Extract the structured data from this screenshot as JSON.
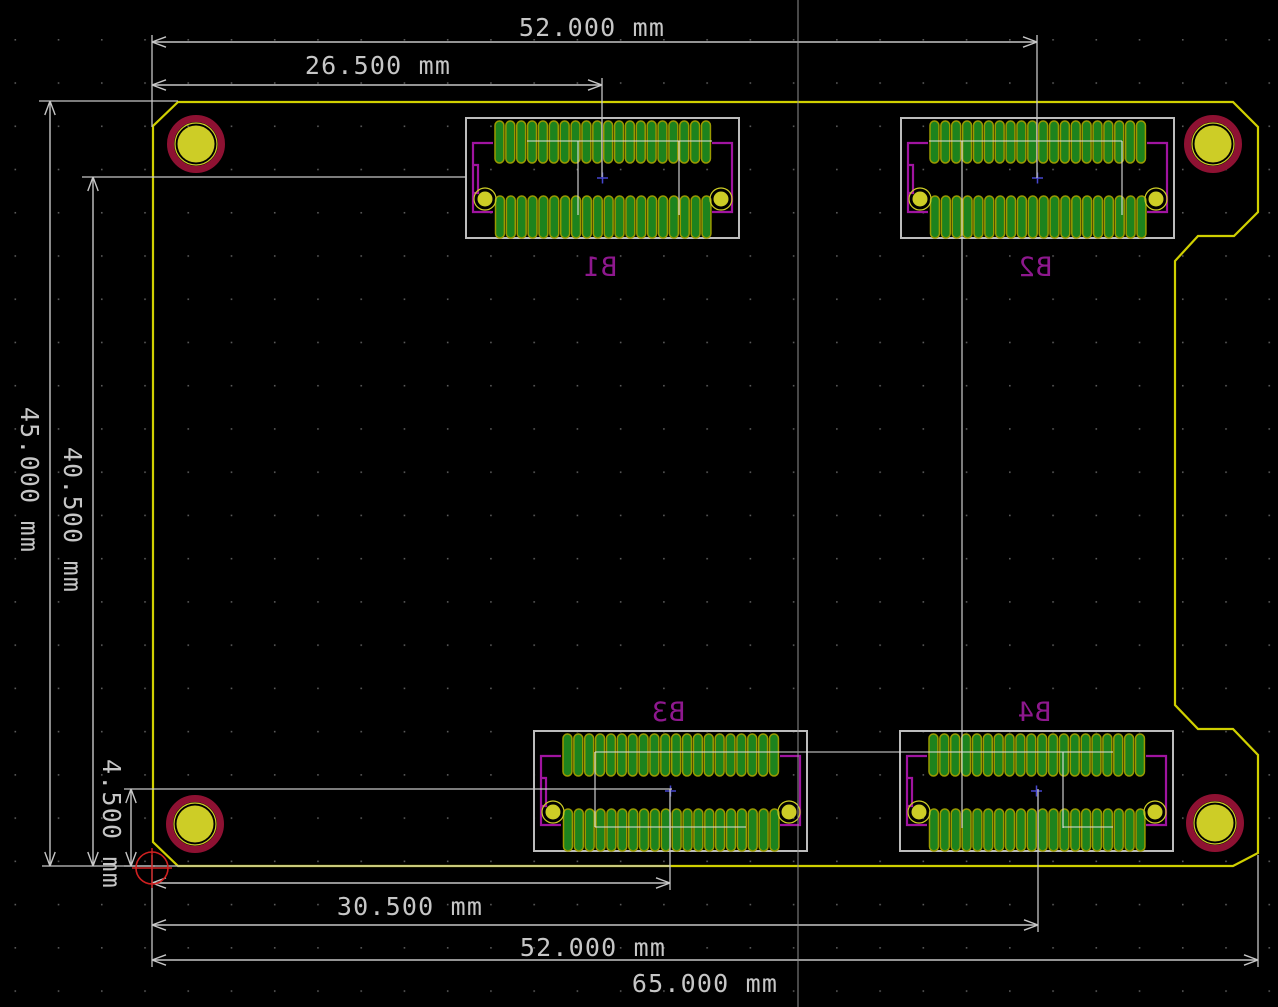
{
  "app": {
    "name": "pcb-editor-canvas",
    "units": "mm"
  },
  "canvas": {
    "width": 1278,
    "height": 1007,
    "background": "#000000"
  },
  "colors": {
    "grid_dot": "#5a5a5a",
    "edge_cuts": "#d0d000",
    "dimension": "#c6c6c6",
    "ratsnest": "#e0e0e0",
    "courtyard": "#bcbcbc",
    "pad_green": "#1d831d",
    "pad_outline": "#9a9a00",
    "pad_yellow": "#cdcd26",
    "hole_ring": "#8e1132",
    "silk_bracket": "#a014a0",
    "silk_label": "#8e188e",
    "anchor_blue": "#4646cf",
    "origin_red": "#d02020",
    "cursor": "#909090"
  },
  "grid": {
    "spacing": 43.24,
    "offset_x": 14.5,
    "offset_y": 39,
    "dot_size": 1.6
  },
  "board": {
    "outline_points": "178,102 1233,102 1258,127 1258,212 1234,236 1198,236 1175,261 1175,705 1198,729 1233,729 1258,755 1258,853 1233,866 178,866 153,842 153,126"
  },
  "mounting_holes": [
    {
      "x": 196,
      "y": 144
    },
    {
      "x": 1213,
      "y": 144
    },
    {
      "x": 195,
      "y": 824
    },
    {
      "x": 1215,
      "y": 823
    }
  ],
  "connector_geom": {
    "width": 273,
    "height": 120,
    "pads_per_row": 20,
    "pad_pitch": 10.87,
    "pad_w": 8.9,
    "pad_h": 42,
    "row1_x": 29,
    "row1_y": 3,
    "row2_x": 29.5,
    "row2_y": 78,
    "hole_pads": [
      {
        "cx": 19,
        "cy": 81
      },
      {
        "cx": 255,
        "cy": 81
      }
    ],
    "bracket_left": "M27 25 H7 V94 H27 M7 47 H12 V75 H7",
    "bracket_right": "M246 25 H266 V94 H246",
    "anchor": {
      "x": 136.5,
      "y": 60
    }
  },
  "connectors": [
    {
      "ref": "B1",
      "x": 466,
      "y": 118,
      "label_pos": "below"
    },
    {
      "ref": "B2",
      "x": 901,
      "y": 118,
      "label_pos": "below"
    },
    {
      "ref": "B3",
      "x": 534,
      "y": 731,
      "label_pos": "above"
    },
    {
      "ref": "B4",
      "x": 900,
      "y": 731,
      "label_pos": "above"
    }
  ],
  "ratsnest": [
    [
      527,
      141,
      712,
      141
    ],
    [
      578,
      141,
      578,
      215
    ],
    [
      679,
      141,
      679,
      215
    ],
    [
      929,
      141,
      1122,
      141
    ],
    [
      1122,
      141,
      1122,
      215
    ],
    [
      962,
      141,
      962,
      828
    ],
    [
      595,
      752,
      1113,
      752
    ],
    [
      595,
      752,
      595,
      827
    ],
    [
      595,
      827,
      746,
      827
    ],
    [
      1063,
      752,
      1063,
      828
    ],
    [
      1063,
      827,
      1113,
      827
    ]
  ],
  "dimensions": [
    {
      "id": "dim-52-top",
      "label": "52.000 mm",
      "orient": "h",
      "line": {
        "y": 42,
        "x1": 152,
        "x2": 1037
      },
      "text": {
        "x": 592,
        "y": 36,
        "rotate": 0
      },
      "ext": [
        [
          152,
          35,
          152,
          127
        ],
        [
          1037,
          35,
          1037,
          178
        ]
      ]
    },
    {
      "id": "dim-26-5",
      "label": "26.500 mm",
      "orient": "h",
      "line": {
        "y": 85,
        "x1": 152,
        "x2": 602
      },
      "text": {
        "x": 378,
        "y": 74,
        "rotate": 0
      },
      "ext": [
        [
          602,
          78,
          602,
          177
        ]
      ]
    },
    {
      "id": "dim-45",
      "label": "45.000 mm",
      "orient": "v",
      "line": {
        "x": 50,
        "y1": 101,
        "y2": 866
      },
      "text": {
        "x": 21,
        "y": 480,
        "rotate": 90
      },
      "ext": [
        [
          39,
          101,
          178,
          101
        ],
        [
          42,
          866,
          155,
          866
        ]
      ]
    },
    {
      "id": "dim-40-5",
      "label": "40.500 mm",
      "orient": "v",
      "line": {
        "x": 93,
        "y1": 177,
        "y2": 866
      },
      "text": {
        "x": 64,
        "y": 520,
        "rotate": 90
      },
      "ext": [
        [
          82,
          177,
          466,
          177
        ]
      ]
    },
    {
      "id": "dim-4-5",
      "label": "4.500 mm",
      "orient": "v",
      "line": {
        "x": 131,
        "y1": 789,
        "y2": 866
      },
      "text": {
        "x": 103,
        "y": 824,
        "rotate": 90
      },
      "ext": [
        [
          124,
          789,
          672,
          789
        ],
        [
          124,
          866,
          670,
          866
        ]
      ]
    },
    {
      "id": "dim-30-5",
      "label": "30.500 mm",
      "orient": "h",
      "line": {
        "y": 883,
        "x1": 152,
        "x2": 670
      },
      "text": {
        "x": 410,
        "y": 915,
        "rotate": 0
      },
      "ext": [
        [
          670,
          789,
          670,
          890
        ]
      ]
    },
    {
      "id": "dim-52-bottom",
      "label": "52.000 mm",
      "orient": "h",
      "line": {
        "y": 925,
        "x1": 152,
        "x2": 1038
      },
      "text": {
        "x": 593,
        "y": 956,
        "rotate": 0
      },
      "ext": [
        [
          1038,
          789,
          1038,
          932
        ]
      ]
    },
    {
      "id": "dim-65",
      "label": "65.000 mm",
      "orient": "h",
      "line": {
        "y": 960,
        "x1": 152,
        "x2": 1258
      },
      "text": {
        "x": 705,
        "y": 992,
        "rotate": 0
      },
      "ext": [
        [
          152,
          855,
          152,
          967
        ],
        [
          1258,
          855,
          1258,
          967
        ]
      ]
    }
  ],
  "cursor": {
    "x": 798
  },
  "origin_marker": {
    "x": 152,
    "y": 868,
    "radius": 16,
    "arm": 20
  }
}
